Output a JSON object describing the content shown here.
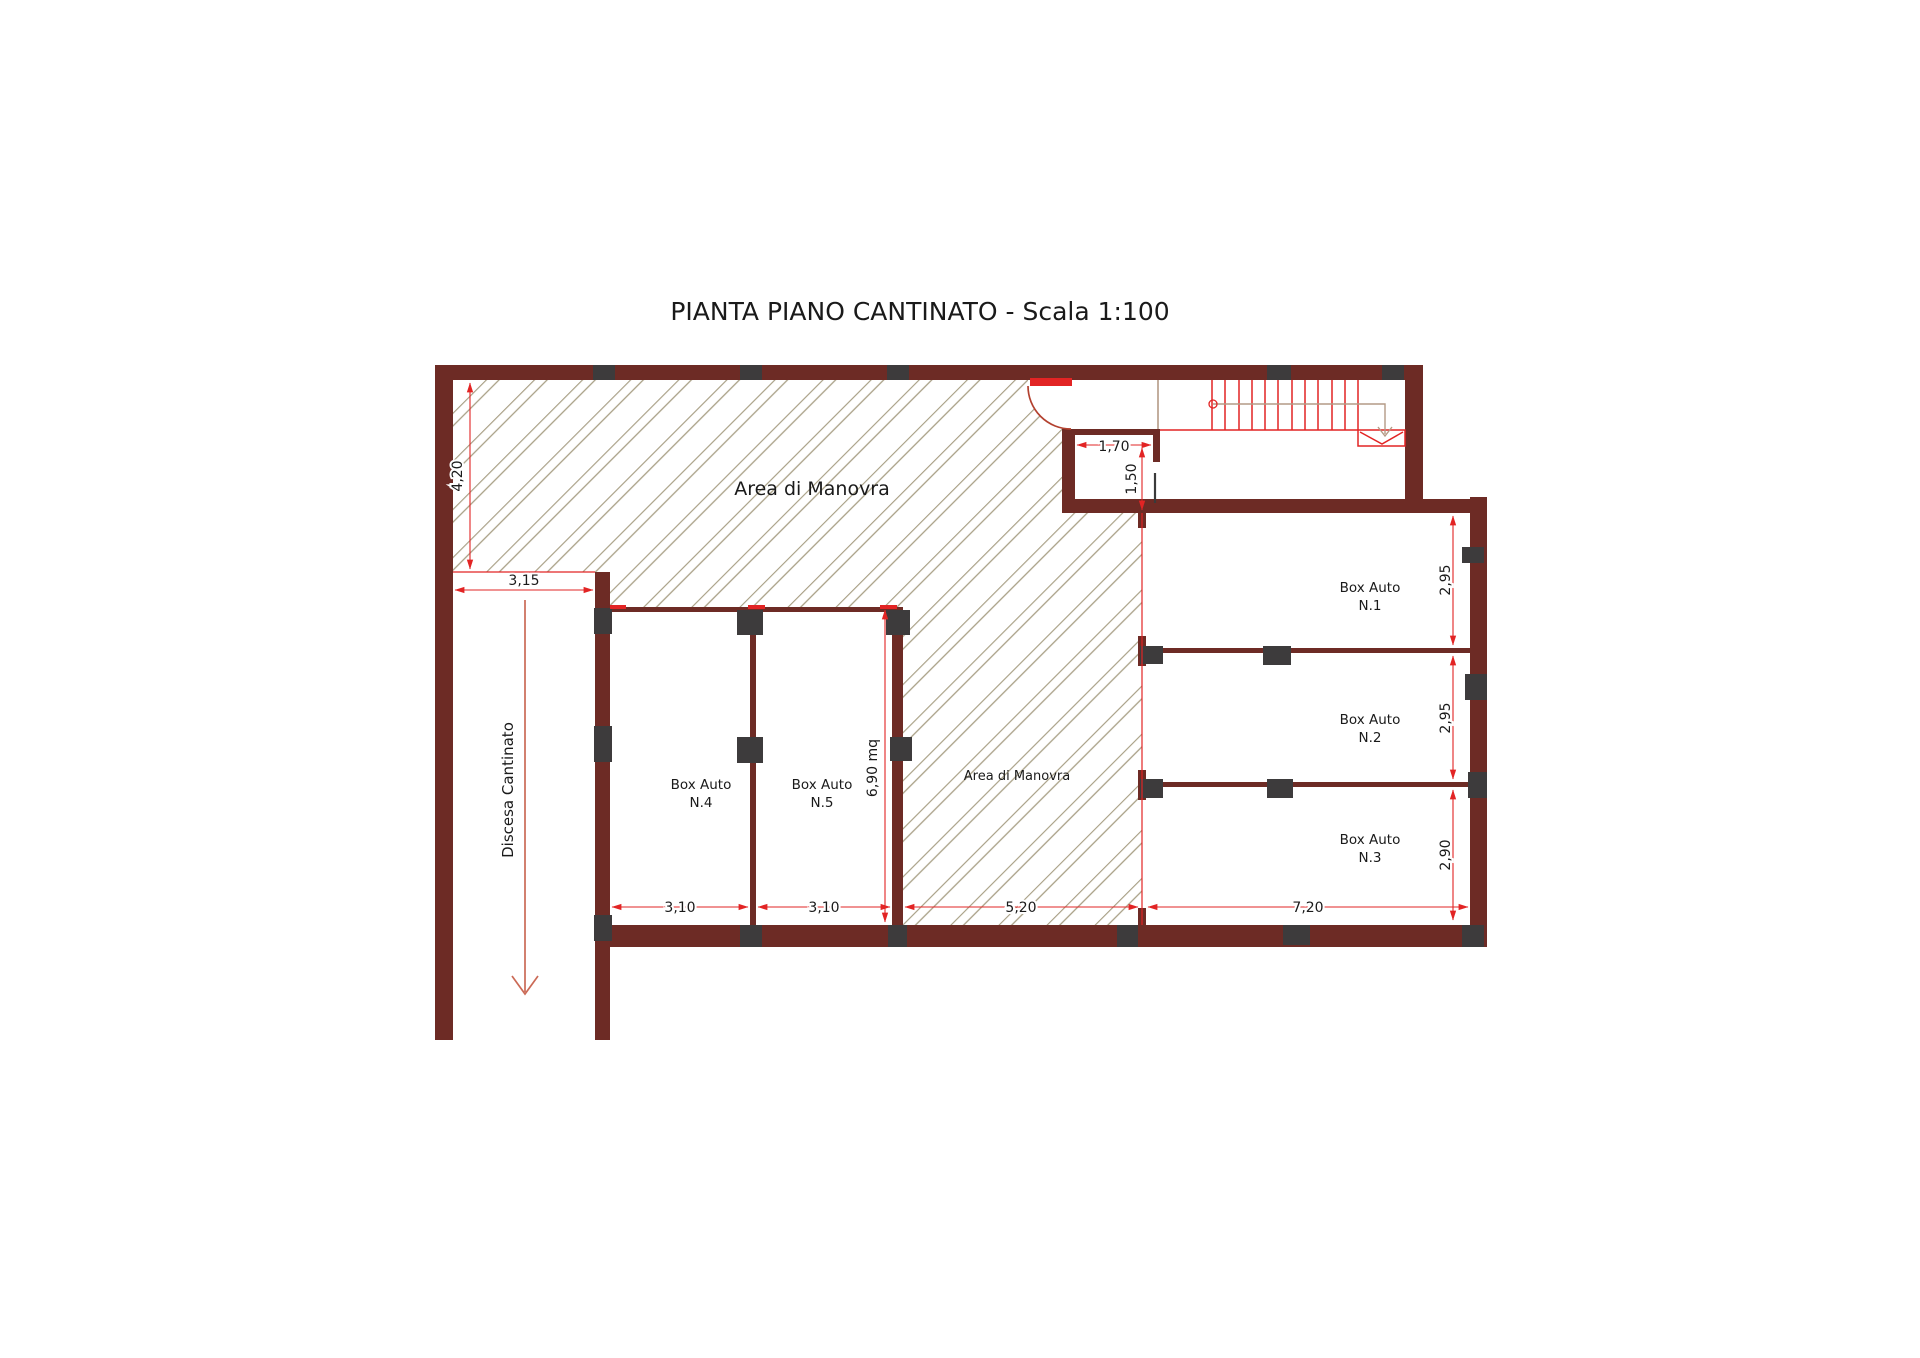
{
  "title": "PIANTA PIANO CANTINATO - Scala 1:100",
  "labels": {
    "area_manovra_upper": "Area di Manovra",
    "area_manovra_central": "Area di Manovra",
    "discesa": "Discesa Cantinato"
  },
  "boxes": [
    {
      "line1": "Box Auto",
      "line2": "N.1"
    },
    {
      "line1": "Box Auto",
      "line2": "N.2"
    },
    {
      "line1": "Box Auto",
      "line2": "N.3"
    },
    {
      "line1": "Box Auto",
      "line2": "N.4"
    },
    {
      "line1": "Box Auto",
      "line2": "N.5"
    }
  ],
  "dimensions": {
    "ramp_height": "4,20",
    "ramp_width": "3,15",
    "room_width": "1,70",
    "room_height": "1,50",
    "box1_height": "2,95",
    "box2_height": "2,95",
    "box3_height": "2,90",
    "box4_width": "3,10",
    "box5_width": "3,10",
    "central_width": "5,20",
    "right_width": "7,20",
    "box5_area": "6,90 mq"
  },
  "colors": {
    "wall": "#6d2b25",
    "pillar": "#3d3b3c",
    "dim": "#e22424",
    "hatch": "#a89f85",
    "door": "#b3412f",
    "walk": "#b49a85",
    "ramp_arrow": "#cb6a56"
  }
}
